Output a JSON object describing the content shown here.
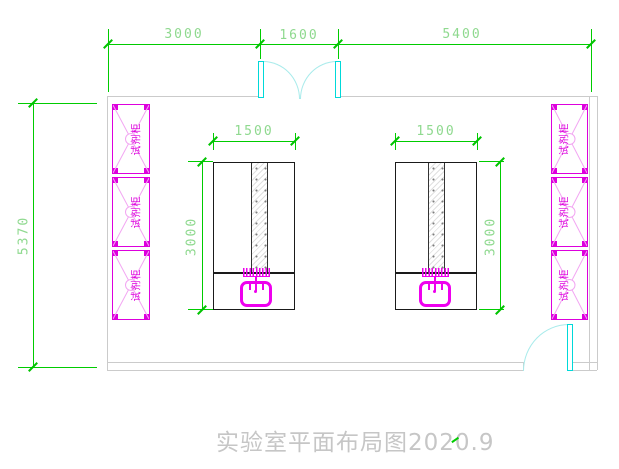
{
  "drawing": {
    "title": "实验室平面布局图2020.9"
  },
  "dimensions": {
    "top_segments": [
      {
        "label": "3000"
      },
      {
        "label": "1600"
      },
      {
        "label": "5400"
      }
    ],
    "room_height": "5370",
    "bench_width_left": "1500",
    "bench_width_right": "1500",
    "bench_depth_left": "3000",
    "bench_depth_right": "3000"
  },
  "furniture": {
    "cabinet_label": "试剂柜"
  },
  "colors": {
    "dimension_line": "#00cc00",
    "dimension_text": "#8fd98f",
    "wall": "#cbcbcb",
    "cabinet": "#dd00dd",
    "cabinet_detail": "#f2a6f2",
    "door": "#00d9d9",
    "door_arc": "#a8ebeb",
    "bench_outline": "#1a1a1a",
    "sink": "#ee00ee",
    "title_text": "#c6c6c6"
  }
}
